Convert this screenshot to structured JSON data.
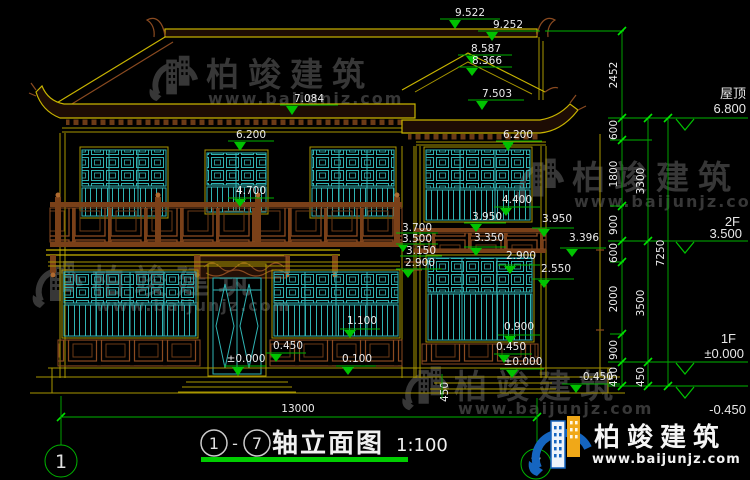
{
  "watermark": {
    "brand": "柏竣建筑",
    "url": "www.baijunjz.com"
  },
  "logo": {
    "brand": "柏竣建筑",
    "url": "www.baijunjz.com"
  },
  "drawing_title": {
    "axis_left": "1",
    "separator": "-",
    "axis_right": "7",
    "name": "轴立面图",
    "scale": "1:100"
  },
  "axis_bubbles": {
    "left": "1",
    "right": "7"
  },
  "floor_levels": {
    "roof_label": "屋顶",
    "roof_value": "6.800",
    "f2_label": "2F",
    "f2_value": "3.500",
    "f1_label": "1F",
    "f1_value": "±0.000",
    "base_value": "-0.450"
  },
  "vertical_chains": {
    "inner": [
      "2452",
      "600",
      "1800",
      "900",
      "600",
      "2000",
      "900",
      "450"
    ],
    "middle": [
      "3300",
      "3500",
      "450"
    ],
    "outer": [
      "7250"
    ]
  },
  "elevation_marks": {
    "ridge_top": "9.522",
    "ridge": "9.252",
    "gable_top": "8.587",
    "gable_inner": "8.366",
    "gable_eave": "7.503",
    "main_eave": "7.084",
    "eave_left": "6.200",
    "eave_right": "6.200",
    "rail_top": "4.700",
    "win_top_right": "4.400",
    "mid_3950_l": "3.950",
    "mid_3350": "3.350",
    "mid_3700": "3.700",
    "mid_3500": "3.500",
    "mid_3150": "3.150",
    "mid_2900_l": "2.900",
    "mid_3950_r": "3.950",
    "mid_3396": "3.396",
    "mid_2900_r": "2.900",
    "mid_2550": "2.550",
    "sill_1100": "1.100",
    "sill_0900": "0.900",
    "step_0450_left": "0.450",
    "zero_left": "±0.000",
    "step_0100": "0.100",
    "step_0450_right": "0.450",
    "zero_right": "±0.000",
    "base_neg_0450": "-0.450",
    "side_450": "450"
  },
  "bottom_dim": {
    "total_width": "13000"
  }
}
